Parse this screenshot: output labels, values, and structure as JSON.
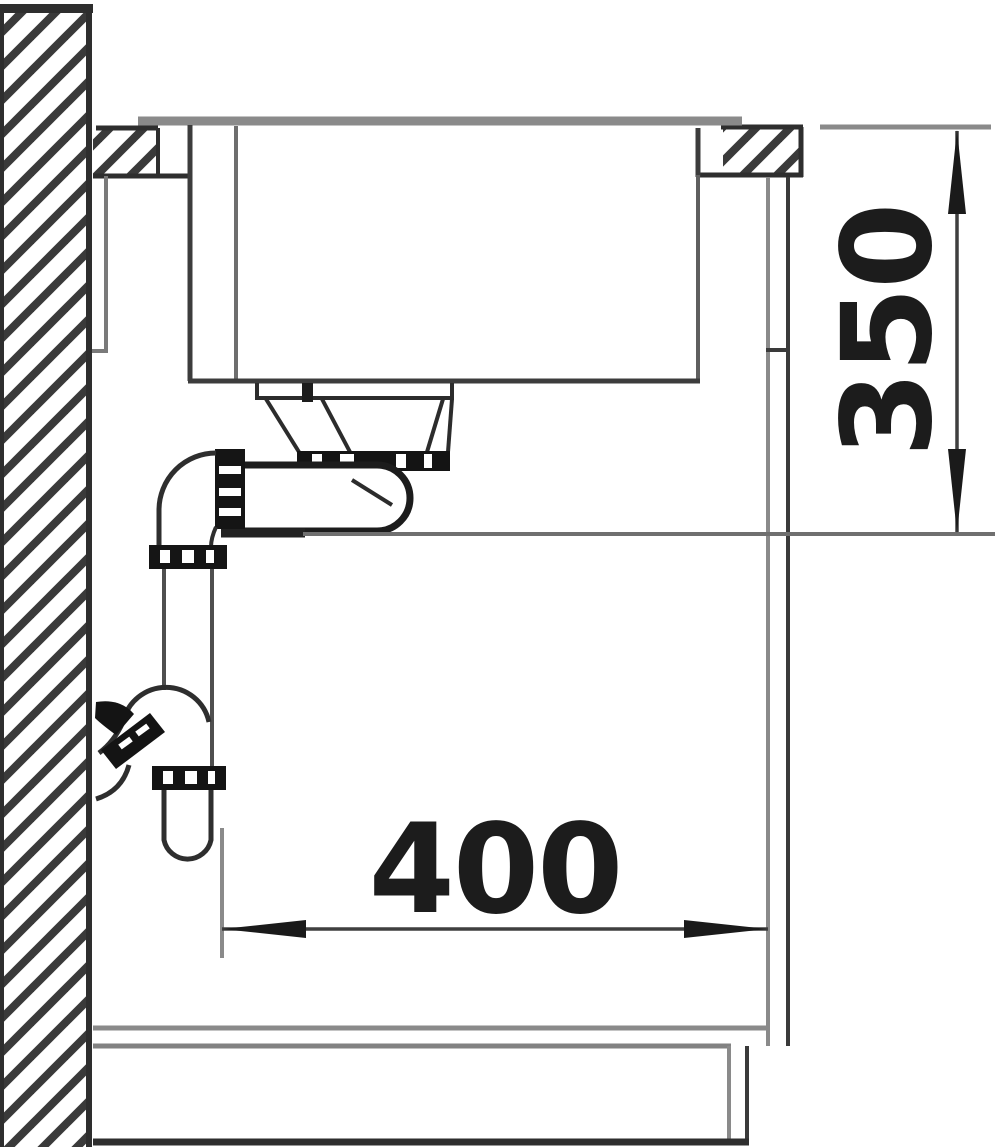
{
  "diagram": {
    "kind": "technical installation drawing - kitchen sink side cross-section with siphon",
    "dimensions": {
      "vertical": {
        "value": "350",
        "orientation": "vertical"
      },
      "horizontal": {
        "value": "400",
        "orientation": "horizontal"
      }
    },
    "colors": {
      "background": "#ffffff",
      "outline_dark": "#2e2e2e",
      "line_gray": "#8a8a8a",
      "fitting_black": "#161616",
      "text": "#1c1c1c"
    }
  }
}
